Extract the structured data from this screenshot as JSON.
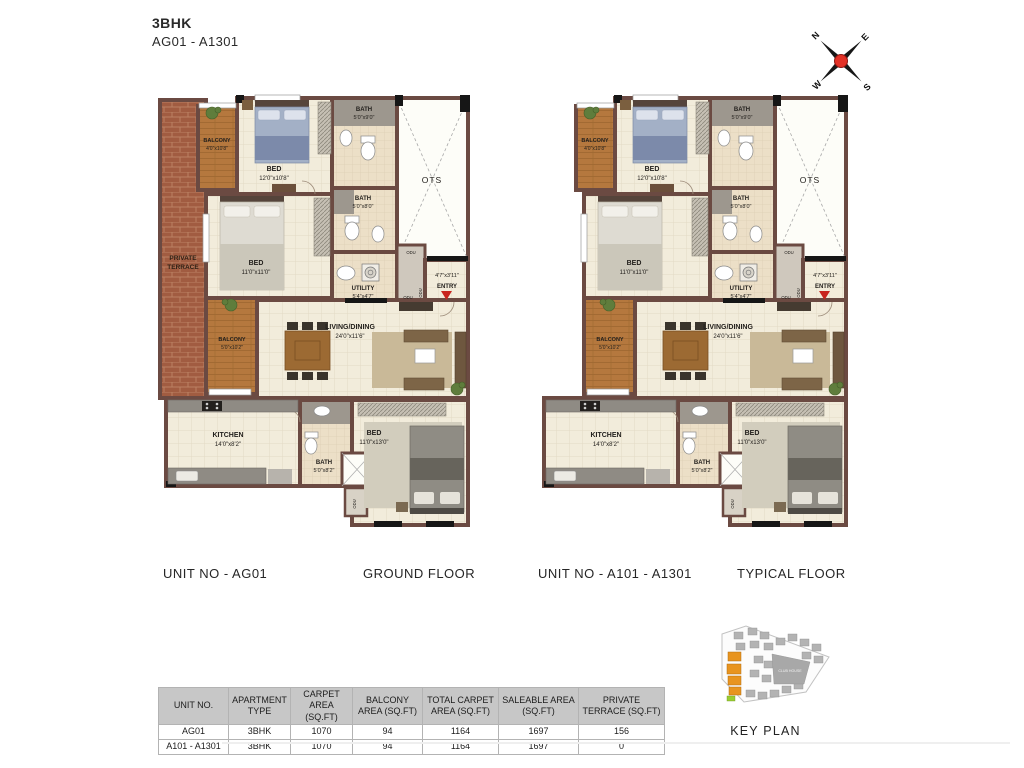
{
  "header": {
    "title": "3BHK",
    "subtitle": "AG01 - A1301"
  },
  "compass": {
    "n": "N",
    "e": "E",
    "s": "S",
    "w": "W"
  },
  "rooms": {
    "private_terrace_l1": "PRIVATE",
    "private_terrace_l2": "TERRACE",
    "balcony1_name": "BALCONY",
    "balcony1_dim": "4'0\"x10'8\"",
    "bed1_name": "BED",
    "bed1_dim": "12'0\"x10'8\"",
    "bath1_name": "BATH",
    "bath1_dim": "5'0\"x9'0\"",
    "ots_label": "OTS",
    "bath2_name": "BATH",
    "bath2_dim": "5'0\"x8'0\"",
    "bed2_name": "BED",
    "bed2_dim": "11'0\"x11'0\"",
    "utility_name": "UTILITY",
    "utility_dim": "5'4\"x4'7\"",
    "entry_dim": "4'7\"x3'11\"",
    "entry_name": "ENTRY",
    "odu": "ODU",
    "balcony2_name": "BALCONY",
    "balcony2_dim": "5'0\"x10'2\"",
    "living_name": "LIVING/DINING",
    "living_dim": "24'0\"x11'6\"",
    "kitchen_name": "KITCHEN",
    "kitchen_dim": "14'0\"x8'2\"",
    "bath3_name": "BATH",
    "bath3_dim": "5'0\"x8'2\"",
    "bed3_name": "BED",
    "bed3_dim": "11'0\"x13'0\""
  },
  "plans": [
    {
      "unit_label": "UNIT NO - AG01",
      "floor_label": "GROUND FLOOR",
      "private_terrace": true
    },
    {
      "unit_label": "UNIT NO - A101 - A1301",
      "floor_label": "TYPICAL FLOOR",
      "private_terrace": false
    }
  ],
  "table": {
    "headers": [
      "UNIT NO.",
      "APARTMENT TYPE",
      "CARPET AREA (SQ.FT)",
      "BALCONY AREA (SQ.FT)",
      "TOTAL CARPET AREA (SQ.FT)",
      "SALEABLE AREA (SQ.FT)",
      "PRIVATE TERRACE (SQ.FT)"
    ],
    "rows": [
      [
        "AG01",
        "3BHK",
        "1070",
        "94",
        "1164",
        "1697",
        "156"
      ],
      [
        "A101 - A1301",
        "3BHK",
        "1070",
        "94",
        "1164",
        "1697",
        "0"
      ]
    ]
  },
  "key_plan": {
    "club_house": "CLUB HOUSE",
    "label": "KEY PLAN"
  },
  "colors": {
    "wall": "#6b4a42",
    "floor_cream": "#f2ecdb",
    "terrace_brick": "#a15c41",
    "balcony_wood": "#b5783e",
    "bath_gray": "#9d978e",
    "accent_red": "#c8241e",
    "keyplan_highlight": "#e8941f",
    "table_header_bg": "#c7c7c7"
  }
}
